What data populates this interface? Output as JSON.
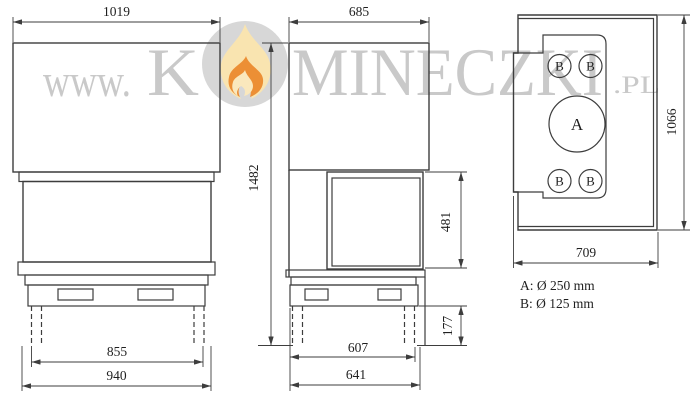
{
  "watermark": {
    "www": "www.",
    "k": "K",
    "rest": "MINECZKI",
    "tld": ".PL"
  },
  "dims": {
    "front_width": "1019",
    "feet_front": "855",
    "base_width": "940",
    "side_depth": "685",
    "total_height": "1482",
    "door_height": "481",
    "leg_height": "177",
    "feet_side": "607",
    "base_depth": "641",
    "plan_height": "1066",
    "plan_width": "709"
  },
  "plan": {
    "label_a": "A",
    "label_b": "B"
  },
  "legend": {
    "line_a": "A: Ø 250 mm",
    "line_b": "B: Ø 125 mm"
  },
  "colors": {
    "line": "#3d3d3d",
    "text": "#1f1f1f",
    "watermark": "#c9c9c9",
    "logo_circle": "#d7d7d7",
    "flame_outer": "#f9e4b0",
    "flame_mid": "#ec8f35",
    "flame_inner": "#fae8bd"
  }
}
